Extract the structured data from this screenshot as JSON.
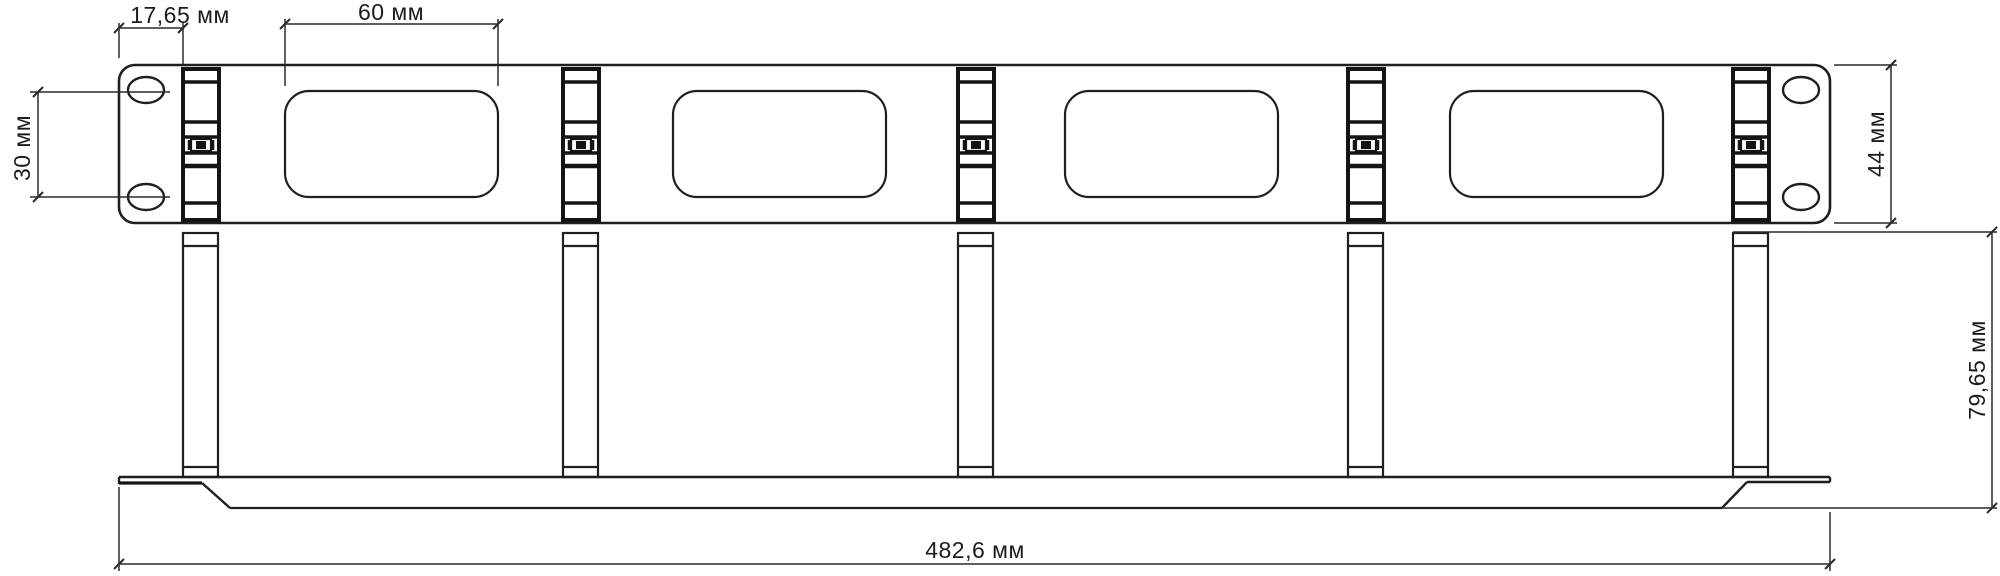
{
  "drawing": {
    "type": "technical-dimension-drawing",
    "subject": "1U rack-mount cable management panel with cable rings",
    "unit": "мм",
    "views": {
      "front_view": {
        "cable_ring_count": 5,
        "cable_slot_count": 4,
        "mounting_hole_count": 4
      },
      "bottom_view": {
        "ring_post_count": 5
      }
    },
    "dimensions": {
      "ear_offset": "17,65 мм",
      "slot_width": "60 мм",
      "hole_spacing": "30 мм",
      "panel_height": "44 мм",
      "total_width": "482,6 мм",
      "ring_depth": "79,65 мм"
    },
    "colors": {
      "line": "#1f1f1f",
      "dimension_line": "#2a2a2a",
      "text": "#1c1c1c",
      "background": "#ffffff"
    }
  }
}
